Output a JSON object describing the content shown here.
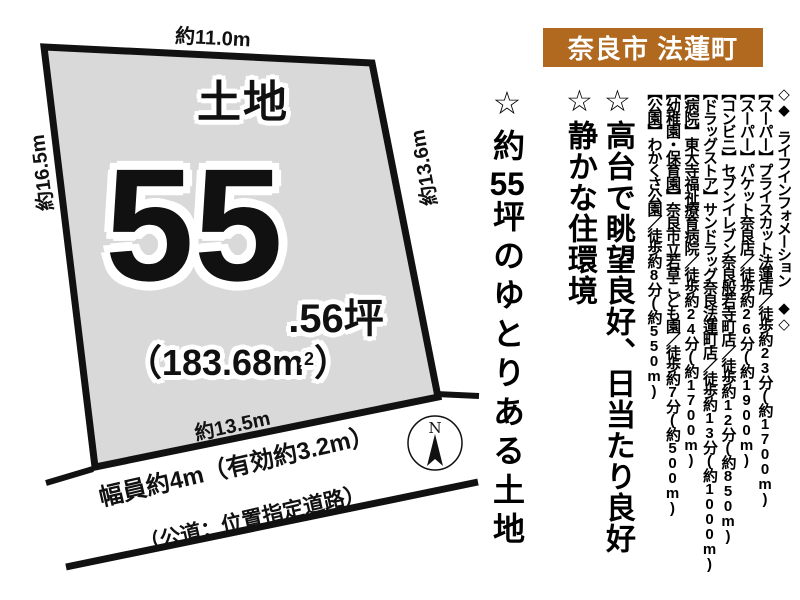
{
  "header": {
    "title": "奈良市 法蓮町"
  },
  "colors": {
    "header_bg": "#b0691e",
    "plot_fill": "#d9d9d9",
    "line": "#111111"
  },
  "plot": {
    "type_label": "土地",
    "tsubo_main": "55",
    "tsubo_fraction": ".56坪",
    "area_pre": "（183.68m",
    "area_sup": "2",
    "area_post": "）",
    "dim_top": "約11.0m",
    "dim_left": "約16.5m",
    "dim_right": "約13.6m",
    "dim_bottom": "約13.5m"
  },
  "road": {
    "width_label": "幅員約4m（有効約3.2m）",
    "type_label": "（公道：位置指定道路）"
  },
  "compass": {
    "north_label": "N"
  },
  "catchphrases": [
    {
      "text": "☆高台で眺望良好、日当たり良好"
    },
    {
      "text": "☆静かな住環境"
    },
    {
      "pre": "☆約",
      "num": "55",
      "post": "坪のゆとりある土地"
    }
  ],
  "life_info": {
    "heading": "◇◆　ライフインフォメーション　◆◇",
    "items": [
      "【スーパー】プライスカット法蓮店／徒歩約23分(約1700m)",
      "【スーパー】パケット奈良店／徒歩約26分(約1900m)",
      "【コンビニ】セブンイレブン奈良般若寺町店／徒歩約12分(約850m)",
      "【ドラッグストア】サンドラッグ奈良法蓮町店／徒歩約13分(約1000m)",
      "【病院】東大寺福祉療育病院／徒歩約24分(約1700m)",
      "【幼稚園・保育園】奈良市立若草こども園／徒歩約7分(約500m)",
      "【公園】わかくさ公園／徒歩約8分(約550m)"
    ]
  }
}
